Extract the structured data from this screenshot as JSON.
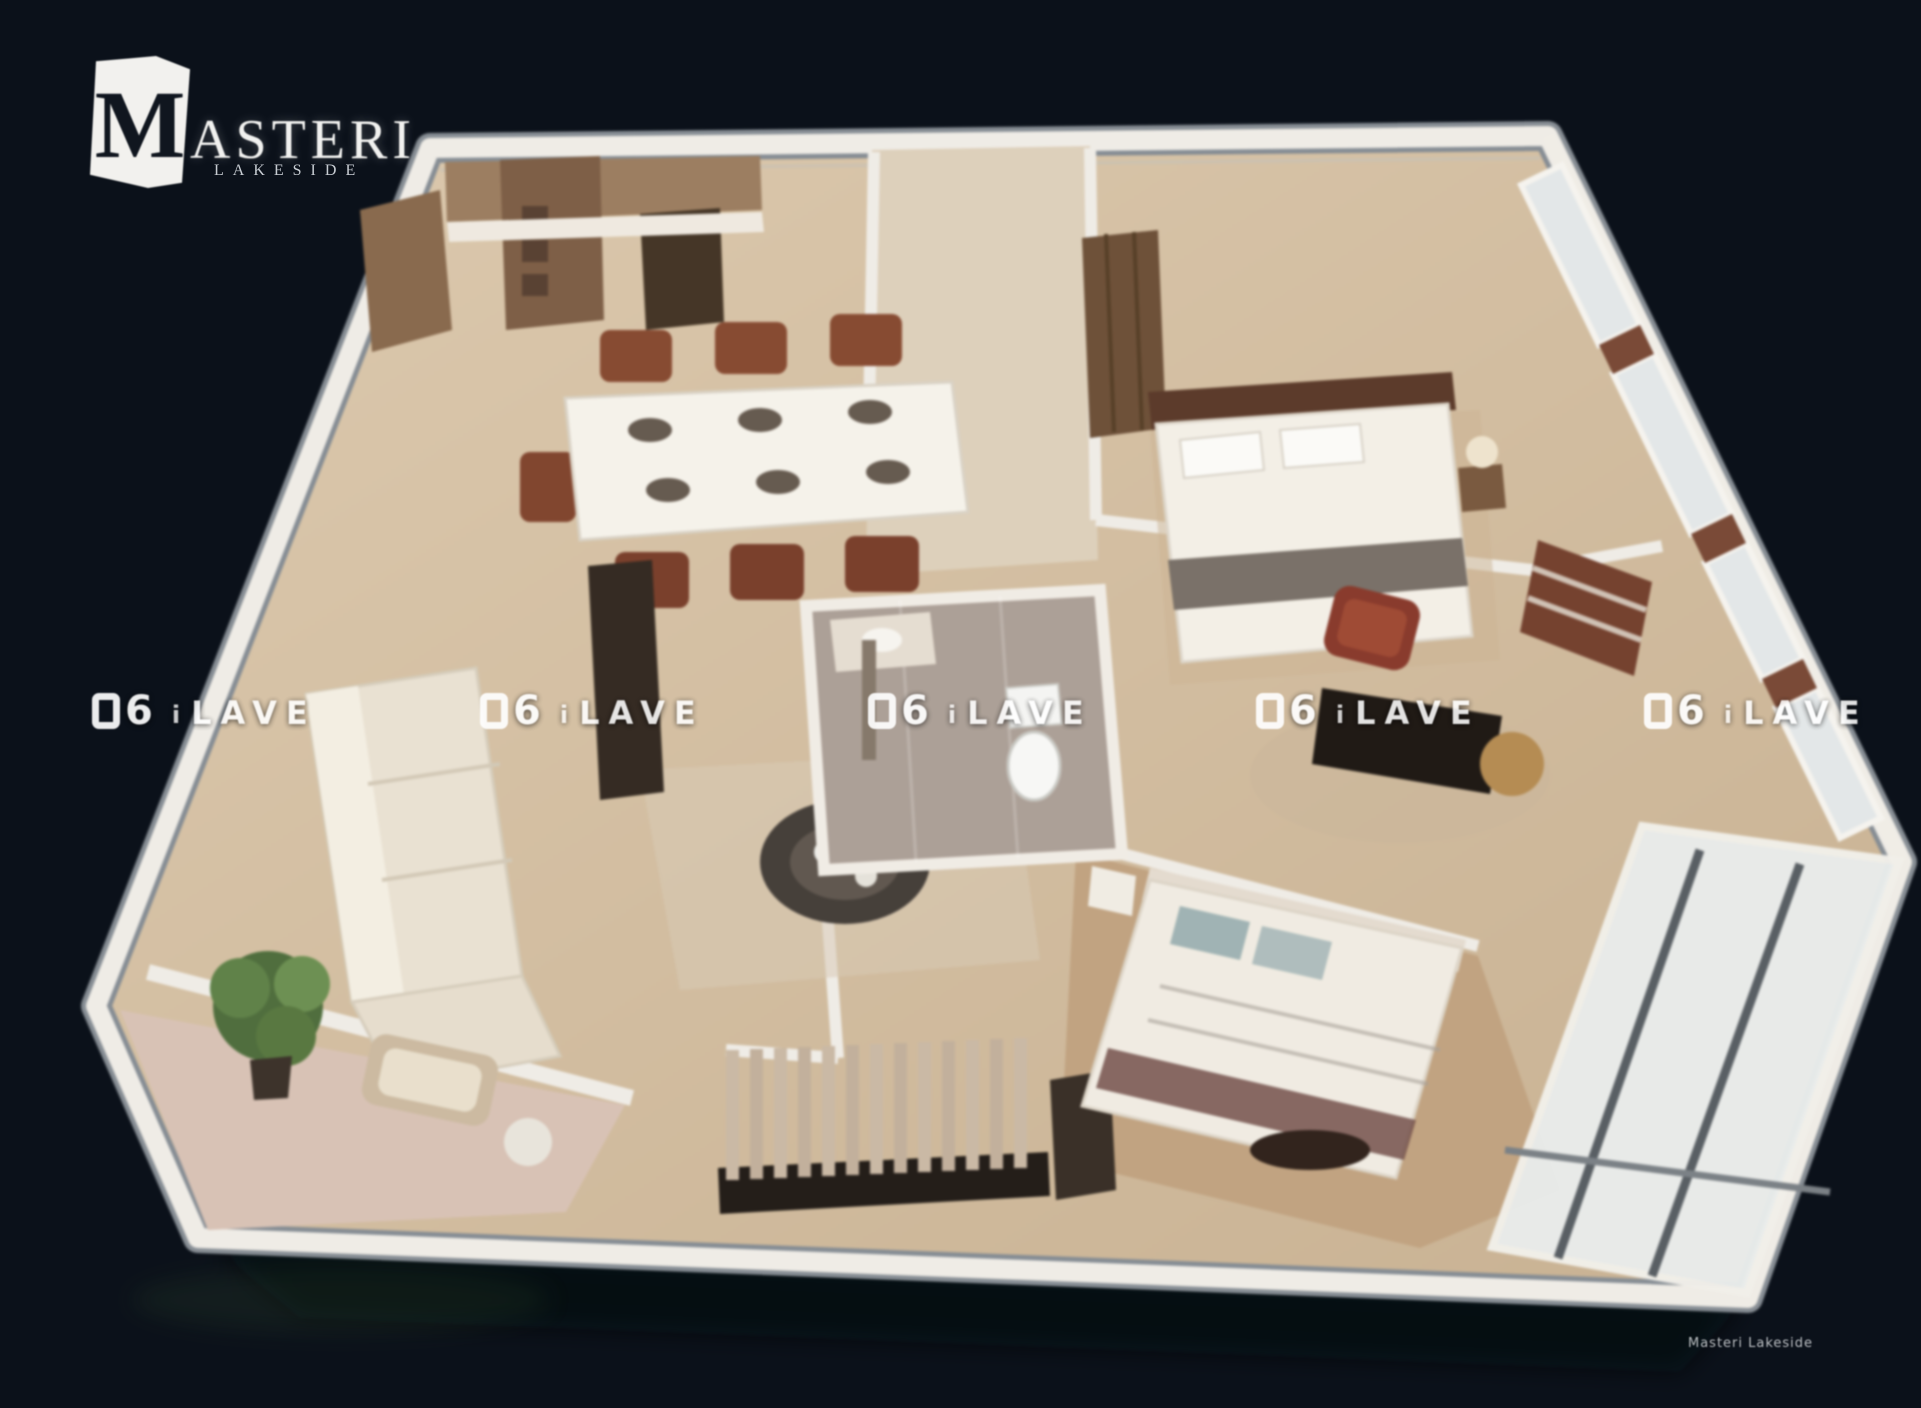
{
  "logo": {
    "initial": "M",
    "wordmark": "ASTERI",
    "brand": "MASTERI",
    "subtitle": "LAKESIDE"
  },
  "watermark": {
    "digit": "6",
    "mid": "i",
    "word": "LAVE",
    "repeat_count": 5
  },
  "credit": {
    "text": "Masteri Lakeside"
  },
  "colors": {
    "background": "#0b111a",
    "wall_white": "#efece6",
    "floor_wood": "#d7c2a5",
    "floor_dark_wood": "#c2a37f",
    "bathroom_tile": "#ada096",
    "sofa_cream": "#e9e1d1",
    "dining_chair_red": "#8a4a30",
    "armchair_red": "#8c3a2b",
    "console_dark": "#241d18",
    "plant_green": "#5d7d46",
    "glass": "#e9eceb",
    "brick_accent": "#7c4a35",
    "watermark_white": "#ffffff"
  },
  "scene": {
    "type": "3d-floor-plan-render",
    "rooms": [
      "kitchen",
      "dining-area",
      "living-room",
      "front-balcony",
      "bathroom",
      "entry-hall",
      "master-bedroom",
      "media-room",
      "second-bedroom",
      "side-loggia"
    ]
  }
}
